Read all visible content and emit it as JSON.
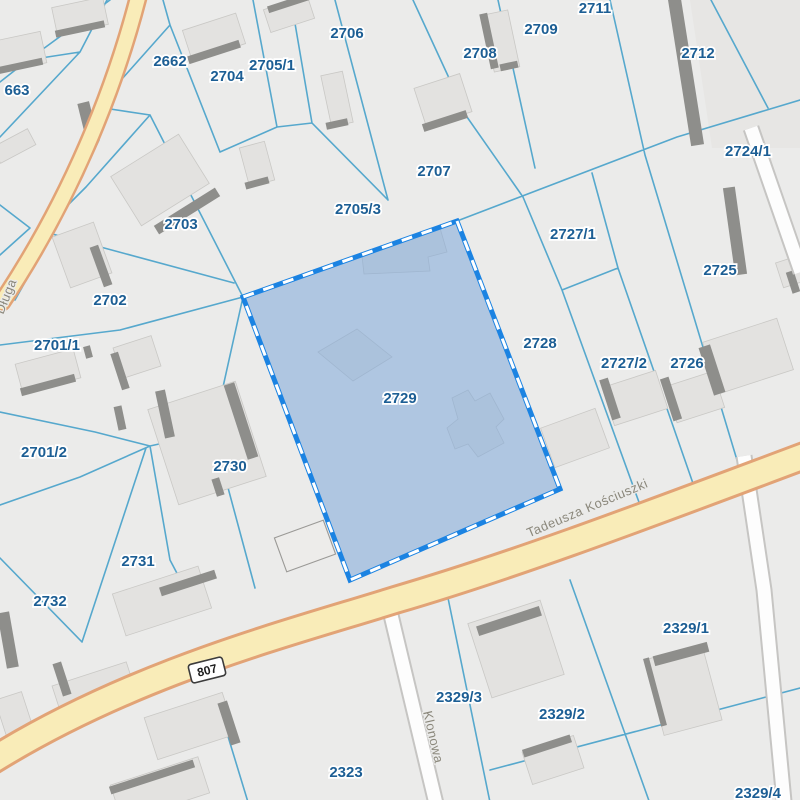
{
  "map": {
    "selected_parcel": {
      "id": "2729"
    },
    "parcels": [
      {
        "id": "2662",
        "x": 170,
        "y": 66
      },
      {
        "id": "663",
        "x": 17,
        "y": 95
      },
      {
        "id": "2704",
        "x": 227,
        "y": 81
      },
      {
        "id": "2705/1",
        "x": 272,
        "y": 70
      },
      {
        "id": "2706",
        "x": 347,
        "y": 38
      },
      {
        "id": "2708",
        "x": 480,
        "y": 58
      },
      {
        "id": "2709",
        "x": 541,
        "y": 34
      },
      {
        "id": "2711",
        "x": 595,
        "y": 13
      },
      {
        "id": "2712",
        "x": 698,
        "y": 58
      },
      {
        "id": "2724/1",
        "x": 748,
        "y": 156
      },
      {
        "id": "2707",
        "x": 434,
        "y": 176
      },
      {
        "id": "2705/3",
        "x": 358,
        "y": 214
      },
      {
        "id": "2703",
        "x": 181,
        "y": 229
      },
      {
        "id": "2702",
        "x": 110,
        "y": 305
      },
      {
        "id": "2701/1",
        "x": 57,
        "y": 350
      },
      {
        "id": "2727/1",
        "x": 573,
        "y": 239
      },
      {
        "id": "2725",
        "x": 720,
        "y": 275
      },
      {
        "id": "2728",
        "x": 540,
        "y": 348
      },
      {
        "id": "2727/2",
        "x": 624,
        "y": 368
      },
      {
        "id": "2726",
        "x": 687,
        "y": 368
      },
      {
        "id": "2729",
        "x": 400,
        "y": 403
      },
      {
        "id": "2701/2",
        "x": 44,
        "y": 457
      },
      {
        "id": "2730",
        "x": 230,
        "y": 471
      },
      {
        "id": "2731",
        "x": 138,
        "y": 566
      },
      {
        "id": "2732",
        "x": 50,
        "y": 606
      },
      {
        "id": "2323",
        "x": 346,
        "y": 777
      },
      {
        "id": "2329/3",
        "x": 459,
        "y": 702
      },
      {
        "id": "2329/2",
        "x": 562,
        "y": 719
      },
      {
        "id": "2329/1",
        "x": 686,
        "y": 633
      },
      {
        "id": "2329/4",
        "x": 758,
        "y": 798
      }
    ],
    "streets": [
      {
        "name": "Długa",
        "x": 10,
        "y": 298,
        "angle": -68
      },
      {
        "name": "Tadeusza Kościuszki",
        "x": 589,
        "y": 512,
        "angle": -23
      },
      {
        "name": "Klonowa",
        "x": 429,
        "y": 738,
        "angle": 77
      }
    ],
    "route_shield": {
      "number": "807",
      "x": 207,
      "y": 670,
      "angle": -14
    },
    "selection_polygon": "457,221 560,489 350,580 243,297",
    "selection_buildings": [
      "362,256 440,228 447,252 428,257 430,271 364,274",
      "318,352 357,329 392,357 353,381",
      "452,398 468,390 475,401 490,393 504,419 496,427 504,443 478,457 468,444 455,449 447,428 458,419"
    ],
    "buildings_light": [
      [
        80,
        16,
        52,
        28,
        -12
      ],
      [
        20,
        52,
        48,
        32,
        -12
      ],
      [
        14,
        146,
        40,
        18,
        -28
      ],
      [
        214,
        37,
        56,
        32,
        -18
      ],
      [
        289,
        14,
        46,
        24,
        -18
      ],
      [
        337,
        99,
        22,
        52,
        -12
      ],
      [
        257,
        164,
        26,
        40,
        -15
      ],
      [
        160,
        180,
        80,
        58,
        -32
      ],
      [
        443,
        100,
        48,
        40,
        -18
      ],
      [
        501,
        41,
        26,
        58,
        -12
      ],
      [
        82,
        255,
        44,
        54,
        -20
      ],
      [
        48,
        371,
        60,
        30,
        -15
      ],
      [
        137,
        357,
        40,
        32,
        -18
      ],
      [
        207,
        443,
        92,
        100,
        -18
      ],
      [
        162,
        601,
        90,
        44,
        -18
      ],
      [
        95,
        692,
        78,
        38,
        -18
      ],
      [
        190,
        726,
        82,
        44,
        -18
      ],
      [
        14,
        714,
        28,
        38,
        -18
      ],
      [
        160,
        789,
        92,
        38,
        -18
      ],
      [
        516,
        649,
        76,
        78,
        -18
      ],
      [
        553,
        760,
        54,
        34,
        -18
      ],
      [
        683,
        690,
        60,
        78,
        -15
      ],
      [
        748,
        356,
        78,
        54,
        -18
      ],
      [
        790,
        272,
        22,
        26,
        -18
      ],
      [
        635,
        398,
        56,
        40,
        -18
      ],
      [
        695,
        397,
        50,
        38,
        -18
      ],
      [
        575,
        438,
        58,
        42,
        -20
      ]
    ],
    "buildings_outline": [
      [
        305,
        546,
        52,
        36,
        -20
      ]
    ],
    "buildings_dark": [
      [
        80,
        29,
        50,
        7,
        -12
      ],
      [
        20,
        66,
        46,
        7,
        -12
      ],
      [
        88,
        122,
        12,
        40,
        -14
      ],
      [
        214,
        52,
        54,
        8,
        -18
      ],
      [
        289,
        3,
        44,
        7,
        -18
      ],
      [
        337,
        124,
        22,
        7,
        -12
      ],
      [
        257,
        183,
        24,
        7,
        -15
      ],
      [
        187,
        211,
        72,
        10,
        -32
      ],
      [
        445,
        121,
        46,
        8,
        -18
      ],
      [
        489,
        41,
        8,
        56,
        -12
      ],
      [
        509,
        66,
        18,
        7,
        -12
      ],
      [
        101,
        266,
        9,
        42,
        -20
      ],
      [
        48,
        385,
        56,
        8,
        -15
      ],
      [
        88,
        352,
        7,
        12,
        -15
      ],
      [
        120,
        371,
        8,
        38,
        -18
      ],
      [
        165,
        414,
        10,
        48,
        -12
      ],
      [
        120,
        418,
        8,
        24,
        -12
      ],
      [
        241,
        421,
        11,
        78,
        -18
      ],
      [
        218,
        487,
        8,
        18,
        -18
      ],
      [
        188,
        583,
        58,
        9,
        -18
      ],
      [
        62,
        679,
        9,
        34,
        -18
      ],
      [
        229,
        723,
        10,
        44,
        -18
      ],
      [
        8,
        640,
        12,
        56,
        -10
      ],
      [
        152,
        777,
        88,
        8,
        -18
      ],
      [
        509,
        621,
        66,
        10,
        -18
      ],
      [
        547,
        746,
        50,
        8,
        -18
      ],
      [
        681,
        654,
        56,
        10,
        -15
      ],
      [
        655,
        692,
        6,
        70,
        -15
      ],
      [
        686,
        72,
        13,
        148,
        -9
      ],
      [
        735,
        231,
        12,
        88,
        -8
      ],
      [
        793,
        282,
        8,
        22,
        -18
      ],
      [
        610,
        399,
        9,
        42,
        -18
      ],
      [
        671,
        399,
        9,
        44,
        -18
      ],
      [
        712,
        370,
        12,
        50,
        -18
      ]
    ],
    "colors": {
      "background": "#ebebea",
      "parcel_boundary": "#56a8cd",
      "parcel_label": "#1c5e94",
      "selection_fill": "#7ea7d9",
      "selection_border": "#1b83e2",
      "road_yellow_fill": "#f9ecb8",
      "road_yellow_casing": "#e2a376",
      "road_white_fill": "#fdfdfd",
      "building_fill": "#e3e2e0",
      "building_shadow": "#8e8e8b",
      "street_label": "#8b887c"
    }
  }
}
